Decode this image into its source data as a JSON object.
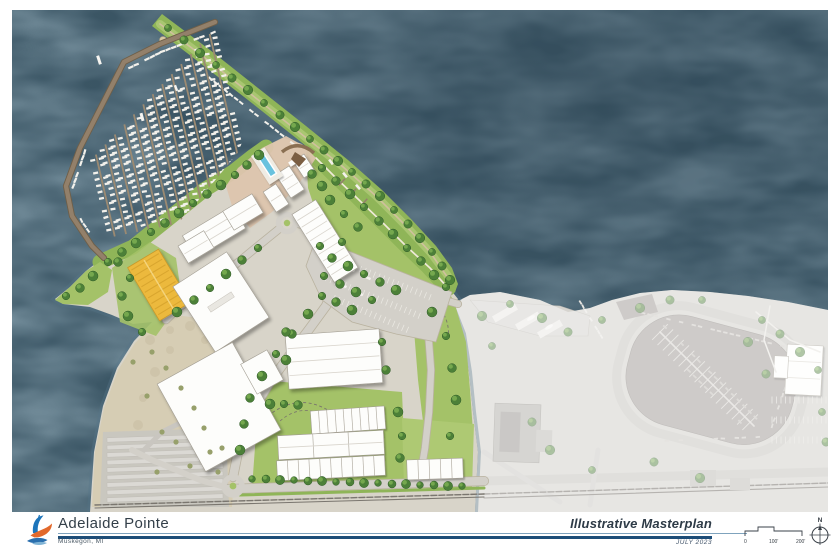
{
  "title_block": {
    "project_name": "Adelaide Pointe",
    "project_location": "Muskegon, MI",
    "sheet_title": "Illustrative Masterplan",
    "sheet_date": "JULY 2023"
  },
  "scale_bar": {
    "zero": "0",
    "mid": "100'",
    "end": "200'"
  },
  "north_arrow": {
    "label": "N"
  },
  "colors": {
    "water": "#3c5766",
    "water_light": "#5d7d8d",
    "land": "#d8d4c9",
    "sand": "#d6cdb4",
    "lawn": "#a4c268",
    "lawn_dark": "#8fb558",
    "tree": "#4c8038",
    "tree_light": "#7fb254",
    "road": "#d3d0c9",
    "plaza": "#ddc5ae",
    "dock": "#93806a",
    "boat": "#f3f1eb",
    "barn_yellow": "#ecb93e",
    "existing_water": "#a7a19d",
    "existing_land": "#d3d2cd",
    "accent_rule_light": "#7fa3bd",
    "accent_rule_dark": "#1d4d78",
    "logo_blue": "#1c75bb",
    "logo_orange": "#e2692c",
    "text_dark": "#333f49"
  },
  "map": {
    "features": [
      "lake-water",
      "west-breakwater-marina",
      "marina-finger-docks",
      "north-breakwater-trail",
      "channel-boat-slips",
      "waterfront-promenade",
      "peninsula-lawn",
      "clubhouse-complex",
      "waterfront-condos",
      "swimming-pool",
      "day-dock",
      "condo-dock-building",
      "boat-barn",
      "boat-storage-buildings",
      "central-parking-lot",
      "townhome-rows",
      "entry-roundabout",
      "north-roundabout",
      "entry-road",
      "shore-road",
      "beach-dunes",
      "boat-storage-yard",
      "railroad",
      "existing-marina-basin",
      "existing-marina-docks",
      "existing-loop-road",
      "existing-buildings",
      "existing-parking",
      "launch-ramps",
      "existing-area-overlay"
    ]
  }
}
